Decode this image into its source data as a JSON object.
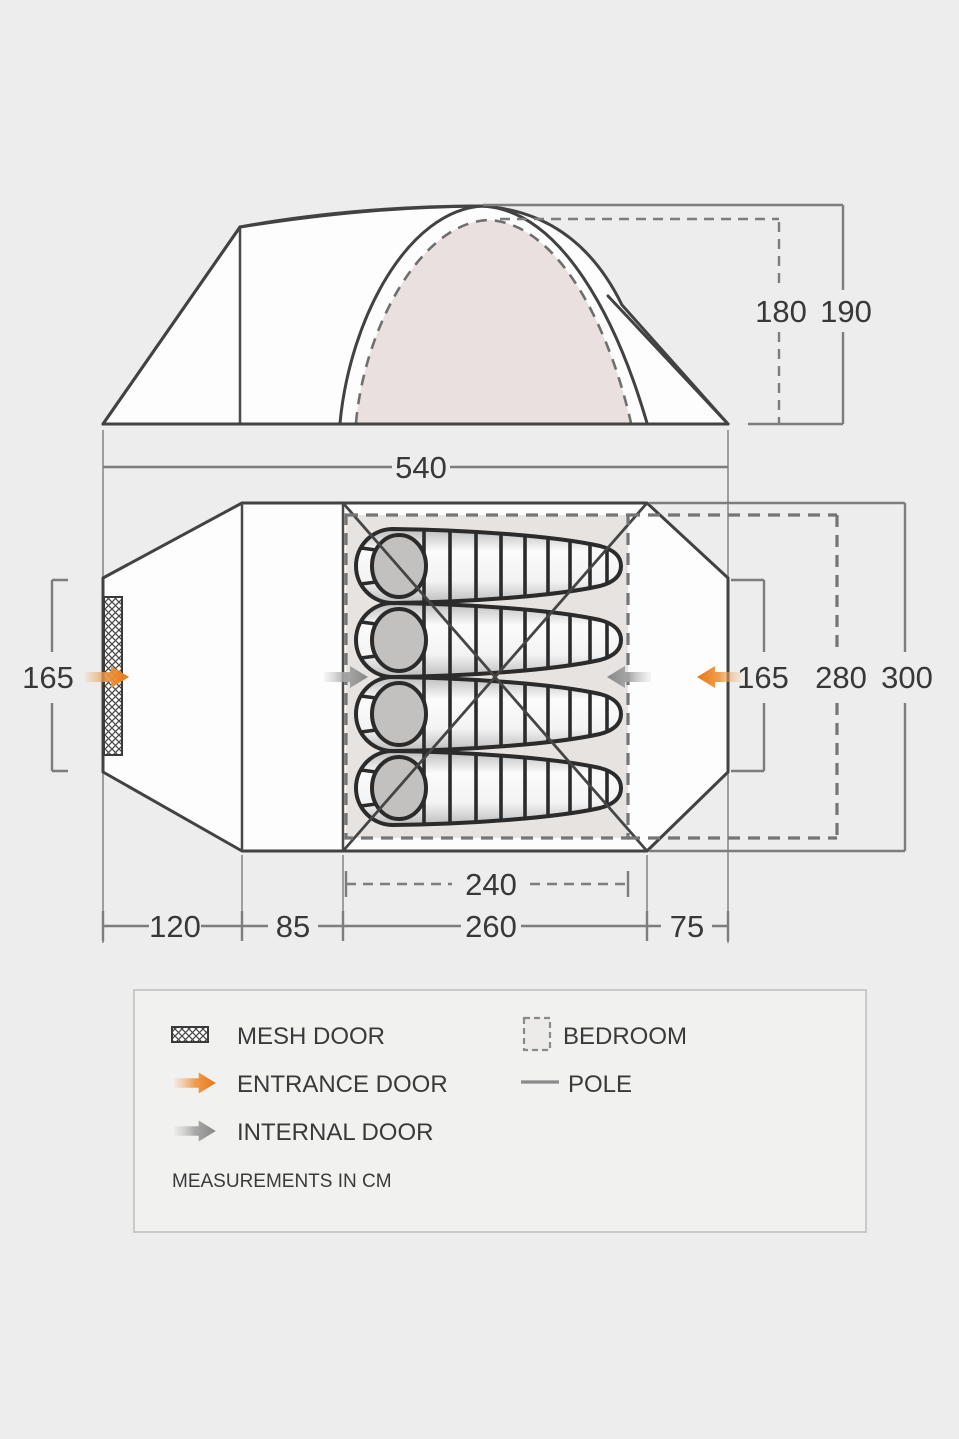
{
  "diagram": {
    "side_view": {
      "total_length": "540",
      "inner_height": "180",
      "outer_height": "190"
    },
    "floor_plan": {
      "left_door_width": "165",
      "right_door_width": "165",
      "inner_width": "280",
      "total_width": "300",
      "bedroom_length": "240",
      "porch_length": "120",
      "middle_length": "85",
      "inner_length": "260",
      "rear_length": "75"
    },
    "legend": {
      "mesh_door": "MESH DOOR",
      "entrance_door": "ENTRANCE DOOR",
      "internal_door": "INTERNAL DOOR",
      "bedroom": "BEDROOM",
      "pole": "POLE",
      "note": "MEASUREMENTS IN CM"
    },
    "colors": {
      "background": "#ededed",
      "line": "#424242",
      "dimension_line": "#7d7d7d",
      "text": "#383838",
      "accent_orange": "#e97613",
      "arrow_gray": "#878787",
      "bedroom_fill": "#e7e3e0",
      "dome_fill": "#eae0df"
    }
  }
}
